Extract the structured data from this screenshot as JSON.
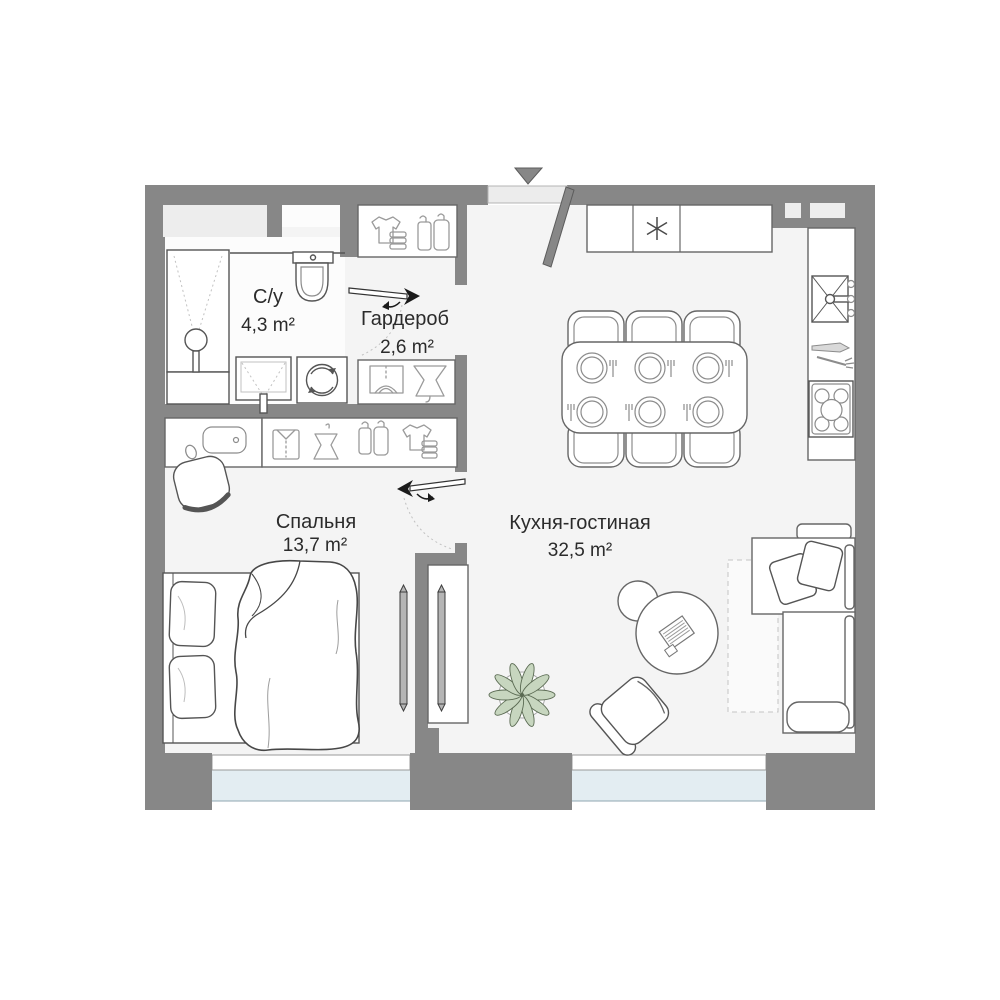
{
  "rooms": [
    {
      "name": "С/у",
      "area": "4,3 m²"
    },
    {
      "name": "Гардероб",
      "area": "2,6 m²"
    },
    {
      "name": "Спальня",
      "area": "13,7 m²"
    },
    {
      "name": "Кухня-гостиная",
      "area": "32,5 m²"
    }
  ],
  "colors": {
    "wall": "#878787",
    "floor": "#f4f4f4",
    "bathroom_floor": "#fcfcfc",
    "window_glass": "#e3edf2",
    "wall_niche": "#ededed",
    "plant_leaf": "#c7d6bf",
    "tv": "#b5b5b5",
    "label_text": "#2b2b2b"
  },
  "icons": {
    "entrance_marker": "triangle-down",
    "entrance_door": "door-leaf-diagonal",
    "fridge_symbol": "snowflake-asterisk",
    "kitchen_sink": "basin-with-faucet",
    "stove": "five-burner-hob",
    "cutlery": "knife-and-fork",
    "washing_machine": "drum-with-arrows",
    "shower": "shower-head",
    "toilet": "toilet-top-view",
    "wardrobe_glyphs": "shirt-dress-hangers-tshirt-stack",
    "sliding_door": "long-arrow",
    "plant": "potted-plant",
    "laptop": "hatched-laptop"
  }
}
